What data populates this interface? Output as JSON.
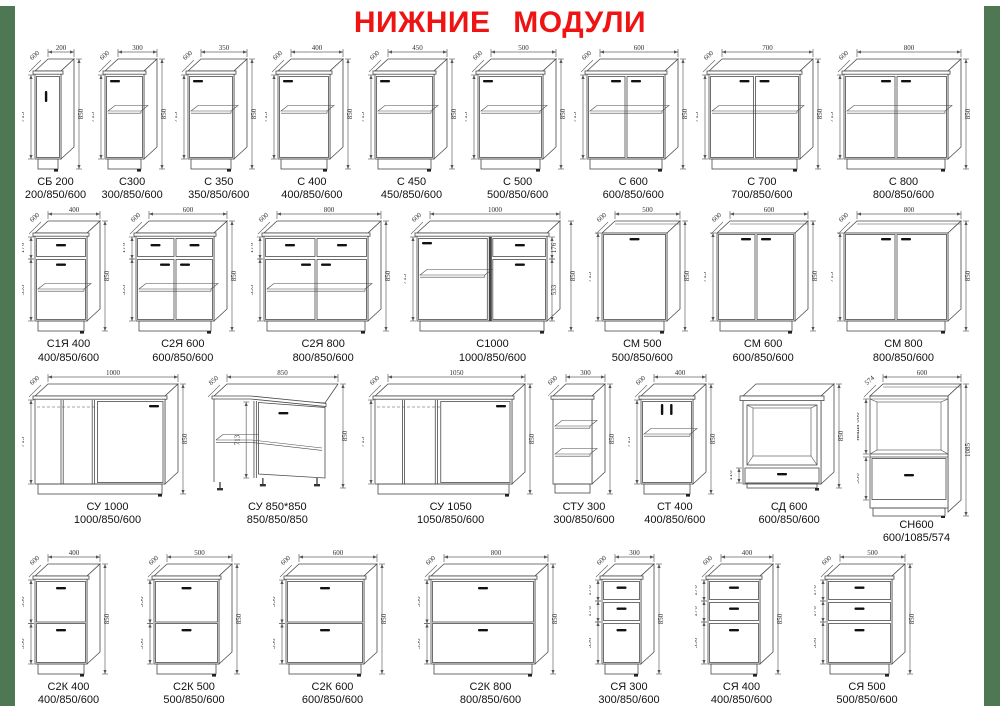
{
  "page": {
    "title": "НИЖНИЕ МОДУЛИ"
  },
  "theme": {
    "title_red": "#ee1414",
    "border_green": "#4e7853",
    "line_color": "#4a4a4a",
    "dim_color": "#333333",
    "handle_color": "#111111"
  },
  "rows": [
    [
      {
        "name": "СБ 200",
        "size": "200/850/600",
        "type": "door1v",
        "wmm": 200,
        "top": "200",
        "depth": "600",
        "left": [
          "713"
        ],
        "right": "850"
      },
      {
        "name": "С300",
        "size": "300/850/600",
        "type": "door1",
        "wmm": 300,
        "top": "300",
        "depth": "600",
        "left": [
          "713"
        ],
        "right": "850"
      },
      {
        "name": "С 350",
        "size": "350/850/600",
        "type": "door1",
        "wmm": 350,
        "top": "350",
        "depth": "600",
        "left": [
          "713"
        ],
        "right": "850"
      },
      {
        "name": "С 400",
        "size": "400/850/600",
        "type": "door1",
        "wmm": 400,
        "top": "400",
        "depth": "600",
        "left": [
          "713"
        ],
        "right": "850"
      },
      {
        "name": "С 450",
        "size": "450/850/600",
        "type": "door1",
        "wmm": 450,
        "top": "450",
        "depth": "600",
        "left": [
          "713"
        ],
        "right": "850"
      },
      {
        "name": "С 500",
        "size": "500/850/600",
        "type": "door1",
        "wmm": 500,
        "top": "500",
        "depth": "600",
        "left": [
          "713"
        ],
        "right": "850"
      },
      {
        "name": "С 600",
        "size": "600/850/600",
        "type": "door2",
        "wmm": 600,
        "top": "600",
        "depth": "600",
        "left": [
          "713"
        ],
        "right": "850"
      },
      {
        "name": "С 700",
        "size": "700/850/600",
        "type": "door2",
        "wmm": 700,
        "top": "700",
        "depth": "600",
        "left": [
          "713"
        ],
        "right": "850"
      },
      {
        "name": "С 800",
        "size": "800/850/600",
        "type": "door2",
        "wmm": 800,
        "top": "800",
        "depth": "600",
        "left": [
          "713"
        ],
        "right": "850"
      }
    ],
    [
      {
        "name": "С1Я 400",
        "size": "400/850/600",
        "type": "drawer1_door1",
        "wmm": 400,
        "top": "400",
        "depth": "600",
        "left": [
          "176",
          "533"
        ],
        "right": "850"
      },
      {
        "name": "С2Я 600",
        "size": "600/850/600",
        "type": "drawer2_door2",
        "wmm": 600,
        "top": "600",
        "depth": "600",
        "left": [
          "176",
          "533"
        ],
        "right": "850"
      },
      {
        "name": "С2Я 800",
        "size": "800/850/600",
        "type": "drawer2_door2",
        "wmm": 800,
        "top": "800",
        "depth": "600",
        "left": [
          "176",
          "533"
        ],
        "right": "850"
      },
      {
        "name": "С1000",
        "size": "1000/850/600",
        "type": "combo1000",
        "wmm": 1000,
        "top": "1000",
        "depth": "600",
        "left": [
          "713"
        ],
        "inner": [
          "176",
          "533"
        ],
        "right": "850"
      },
      {
        "name": "СМ 500",
        "size": "500/850/600",
        "type": "sink1",
        "wmm": 500,
        "top": "500",
        "depth": "600",
        "left": [
          "713"
        ],
        "right": "850"
      },
      {
        "name": "СМ 600",
        "size": "600/850/600",
        "type": "sink2",
        "wmm": 600,
        "top": "600",
        "depth": "600",
        "left": [
          "713"
        ],
        "right": "850"
      },
      {
        "name": "СМ 800",
        "size": "800/850/600",
        "type": "sink2",
        "wmm": 800,
        "top": "800",
        "depth": "600",
        "left": [
          "713"
        ],
        "right": "850"
      }
    ],
    [
      {
        "name": "СУ 1000",
        "size": "1000/850/600",
        "type": "corner",
        "wmm": 1000,
        "top": "1000",
        "depth": "600",
        "left": [
          "713"
        ],
        "right": "850"
      },
      {
        "name": "СУ 850*850",
        "size": "850/850/850",
        "type": "corner_sink",
        "wmm": 850,
        "top": "850",
        "depth": "850",
        "left": [
          "713"
        ],
        "right": "850"
      },
      {
        "name": "СУ 1050",
        "size": "1050/850/600",
        "type": "corner",
        "wmm": 1050,
        "top": "1050",
        "depth": "600",
        "left": [
          "713"
        ],
        "right": "850"
      },
      {
        "name": "СТУ 300",
        "size": "300/850/600",
        "type": "open_shelf",
        "wmm": 300,
        "top": "300",
        "depth": "600",
        "left": [],
        "right": "850"
      },
      {
        "name": "СТ 400",
        "size": "400/850/600",
        "type": "tray",
        "wmm": 400,
        "top": "400",
        "depth": "600",
        "left": [
          "713"
        ],
        "right": "850"
      },
      {
        "name": "СД 600",
        "size": "600/850/600",
        "type": "oven",
        "wmm": 600,
        "left": [
          "116"
        ],
        "right": "850"
      },
      {
        "name": "СН600",
        "size": "600/1085/574",
        "type": "tall_niche",
        "wmm": 600,
        "top": "600",
        "depth": "574",
        "left": [
          "ниша 600",
          "356"
        ],
        "right": "1085"
      }
    ],
    [
      {
        "name": "С2К 400",
        "size": "400/850/600",
        "type": "drawers2",
        "wmm": 400,
        "top": "400",
        "depth": "600",
        "left": [
          "356",
          "356"
        ],
        "right": "850"
      },
      {
        "name": "С2К 500",
        "size": "500/850/600",
        "type": "drawers2",
        "wmm": 500,
        "top": "500",
        "depth": "600",
        "left": [
          "356",
          "356"
        ],
        "right": "850"
      },
      {
        "name": "С2К 600",
        "size": "600/850/600",
        "type": "drawers2",
        "wmm": 600,
        "top": "600",
        "depth": "600",
        "left": [
          "356",
          "356"
        ],
        "right": "850"
      },
      {
        "name": "С2К 800",
        "size": "800/850/600",
        "type": "drawers2",
        "wmm": 800,
        "top": "800",
        "depth": "600",
        "left": [
          "356",
          "356"
        ],
        "right": "850"
      },
      {
        "name": "СЯ 300",
        "size": "300/850/600",
        "type": "drawers3",
        "wmm": 300,
        "top": "300",
        "depth": "600",
        "left": [
          "176",
          "176",
          "356"
        ],
        "right": "850"
      },
      {
        "name": "СЯ 400",
        "size": "400/850/600",
        "type": "drawers3",
        "wmm": 400,
        "top": "400",
        "depth": "600",
        "left": [
          "176",
          "176",
          "356"
        ],
        "right": "850"
      },
      {
        "name": "СЯ 500",
        "size": "500/850/600",
        "type": "drawers3",
        "wmm": 500,
        "top": "500",
        "depth": "600",
        "left": [
          "176",
          "176",
          "356"
        ],
        "right": "850"
      }
    ]
  ]
}
